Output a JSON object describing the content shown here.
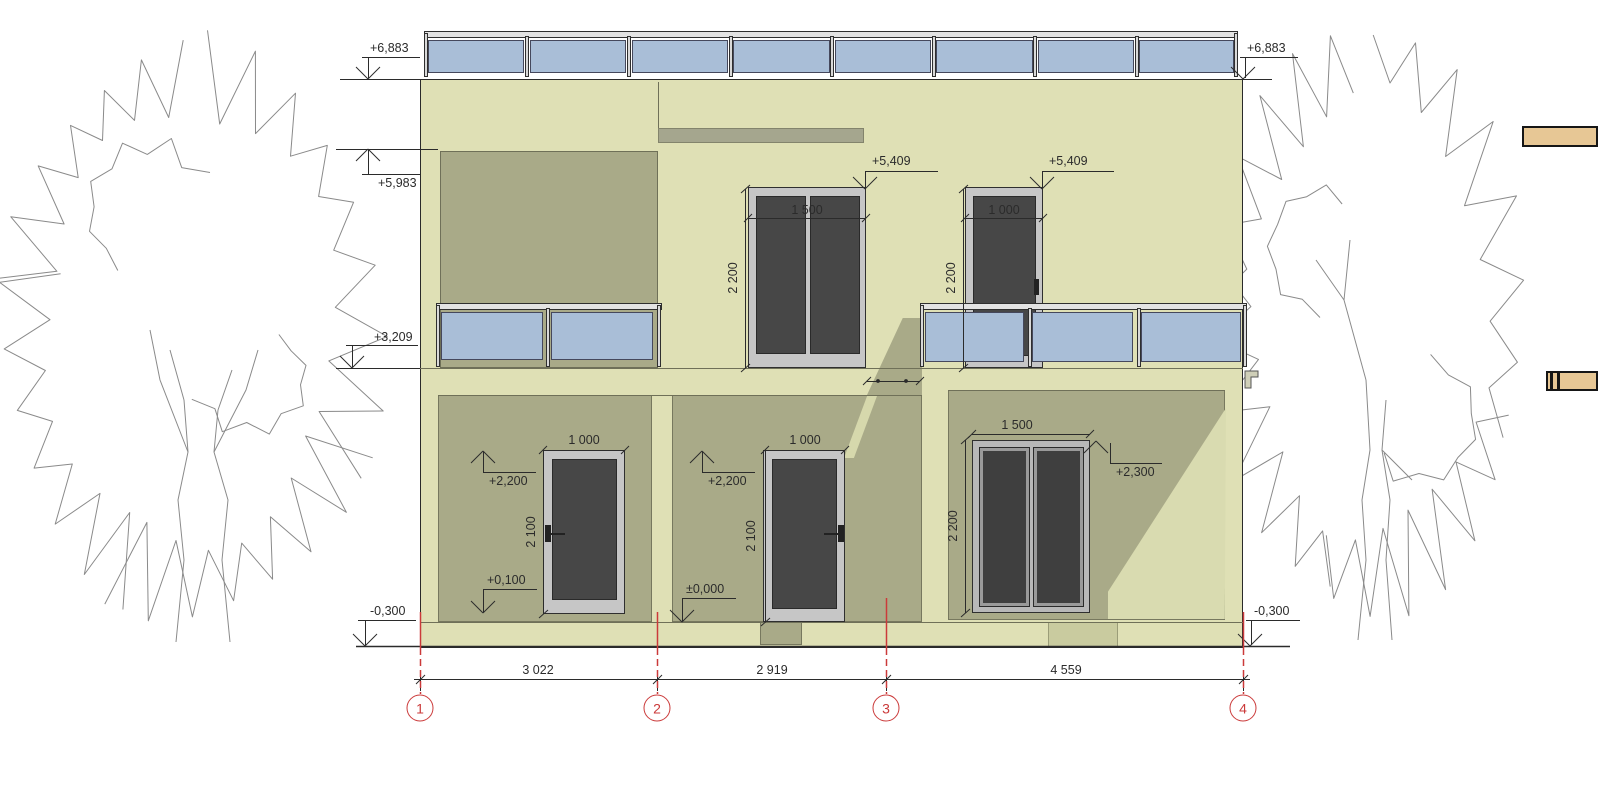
{
  "drawing": {
    "kind": "architectural-elevation",
    "colors": {
      "facade": "#dfe0b5",
      "recess_shadow": "#a9aa88",
      "canopy_band": "#a5a68e",
      "glass_railing": "#a9bed7",
      "door_glass": "#474747",
      "frame_gray": "#c6c6c6",
      "axis_red": "#cb3a3a",
      "wood": "#e7c795",
      "tree_outline": "#8a8a8a"
    }
  },
  "levels": {
    "parapet_left": "+6,883",
    "parapet_right": "+6,883",
    "niche_top": "+5,983",
    "balcony_floor": "+3,209",
    "ground_left": "-0,300",
    "ground_right": "-0,300",
    "upper_door_left_top": "+5,409",
    "upper_door_right_top": "+5,409",
    "door1_head": "+2,200",
    "door2_head": "+2,200",
    "window_head": "+2,300",
    "door1_sill": "+0,100",
    "door2_sill": "±0,000"
  },
  "dims": {
    "upper_double_door_width": "1 500",
    "upper_double_door_height": "2 200",
    "upper_single_door_width": "1 000",
    "upper_single_door_height": "2 200",
    "door1_width": "1 000",
    "door1_height": "2 100",
    "door2_width": "1 000",
    "door2_height": "2 100",
    "window_width": "1 500",
    "window_height": "2 200",
    "span_1_2": "3 022",
    "span_2_3": "2 919",
    "span_3_4": "4 559"
  },
  "axes": {
    "labels": [
      "1",
      "2",
      "3",
      "4"
    ]
  }
}
